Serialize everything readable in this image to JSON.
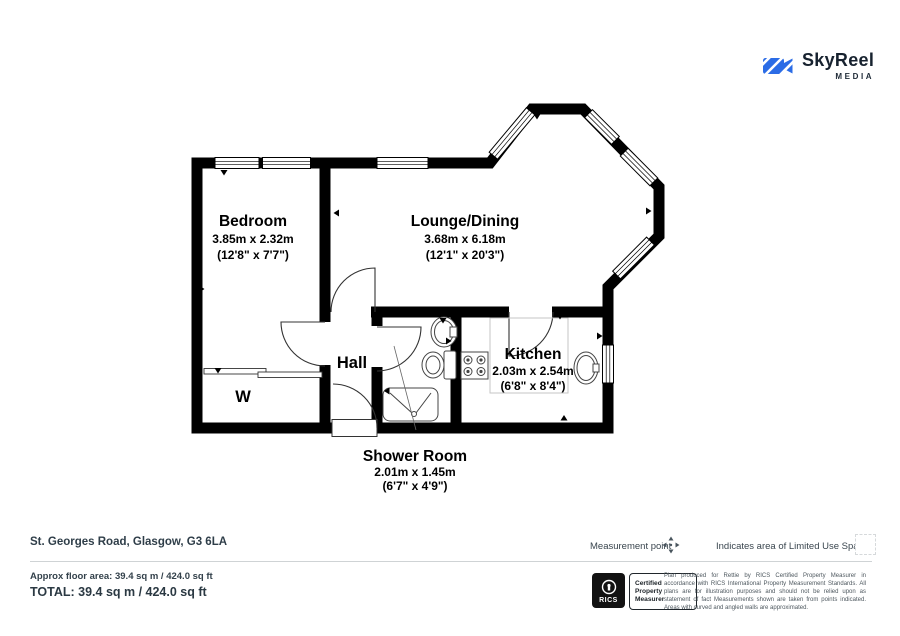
{
  "logo": {
    "brand": "SkyReel",
    "media": "MEDIA",
    "accent_blue": "#2b6ce6",
    "text_dark": "#17222f"
  },
  "plan": {
    "wall_color": "#000000",
    "rooms": [
      {
        "name": "Bedroom",
        "metric": "3.85m x 2.32m",
        "imperial": "(12'8\" x 7'7\")"
      },
      {
        "name": "Lounge/Dining",
        "metric": "3.68m x 6.18m",
        "imperial": "(12'1\" x 20'3\")"
      },
      {
        "name": "Hall"
      },
      {
        "name": "Kitchen",
        "metric": "2.03m x 2.54m",
        "imperial": "(6'8\" x 8'4\")"
      },
      {
        "name": "Shower Room",
        "metric": "2.01m x 1.45m",
        "imperial": "(6'7\" x 4'9\")"
      },
      {
        "name": "W"
      }
    ]
  },
  "footer": {
    "address": "St. Georges Road, Glasgow, G3 6LA",
    "measurement_point_label": "Measurement point",
    "limited_use_label": "Indicates area of  Limited Use Space",
    "approx_area": "Approx floor area: 39.4 sq m / 424.0 sq ft",
    "total": "TOTAL: 39.4 sq m / 424.0 sq ft",
    "rics": {
      "org": "RICS",
      "cert_lines": [
        "Certified",
        "Property",
        "Measurer"
      ]
    },
    "disclaimer": "Plan produced for Rettie by RICS Certified Property Measurer in accordance with RICS International Property Measurement Standards.  All plans are for illustration purposes and should not be relied upon as statement of fact Measurements shown are taken from points indicated. Areas with curved and angled walls are approximated."
  }
}
